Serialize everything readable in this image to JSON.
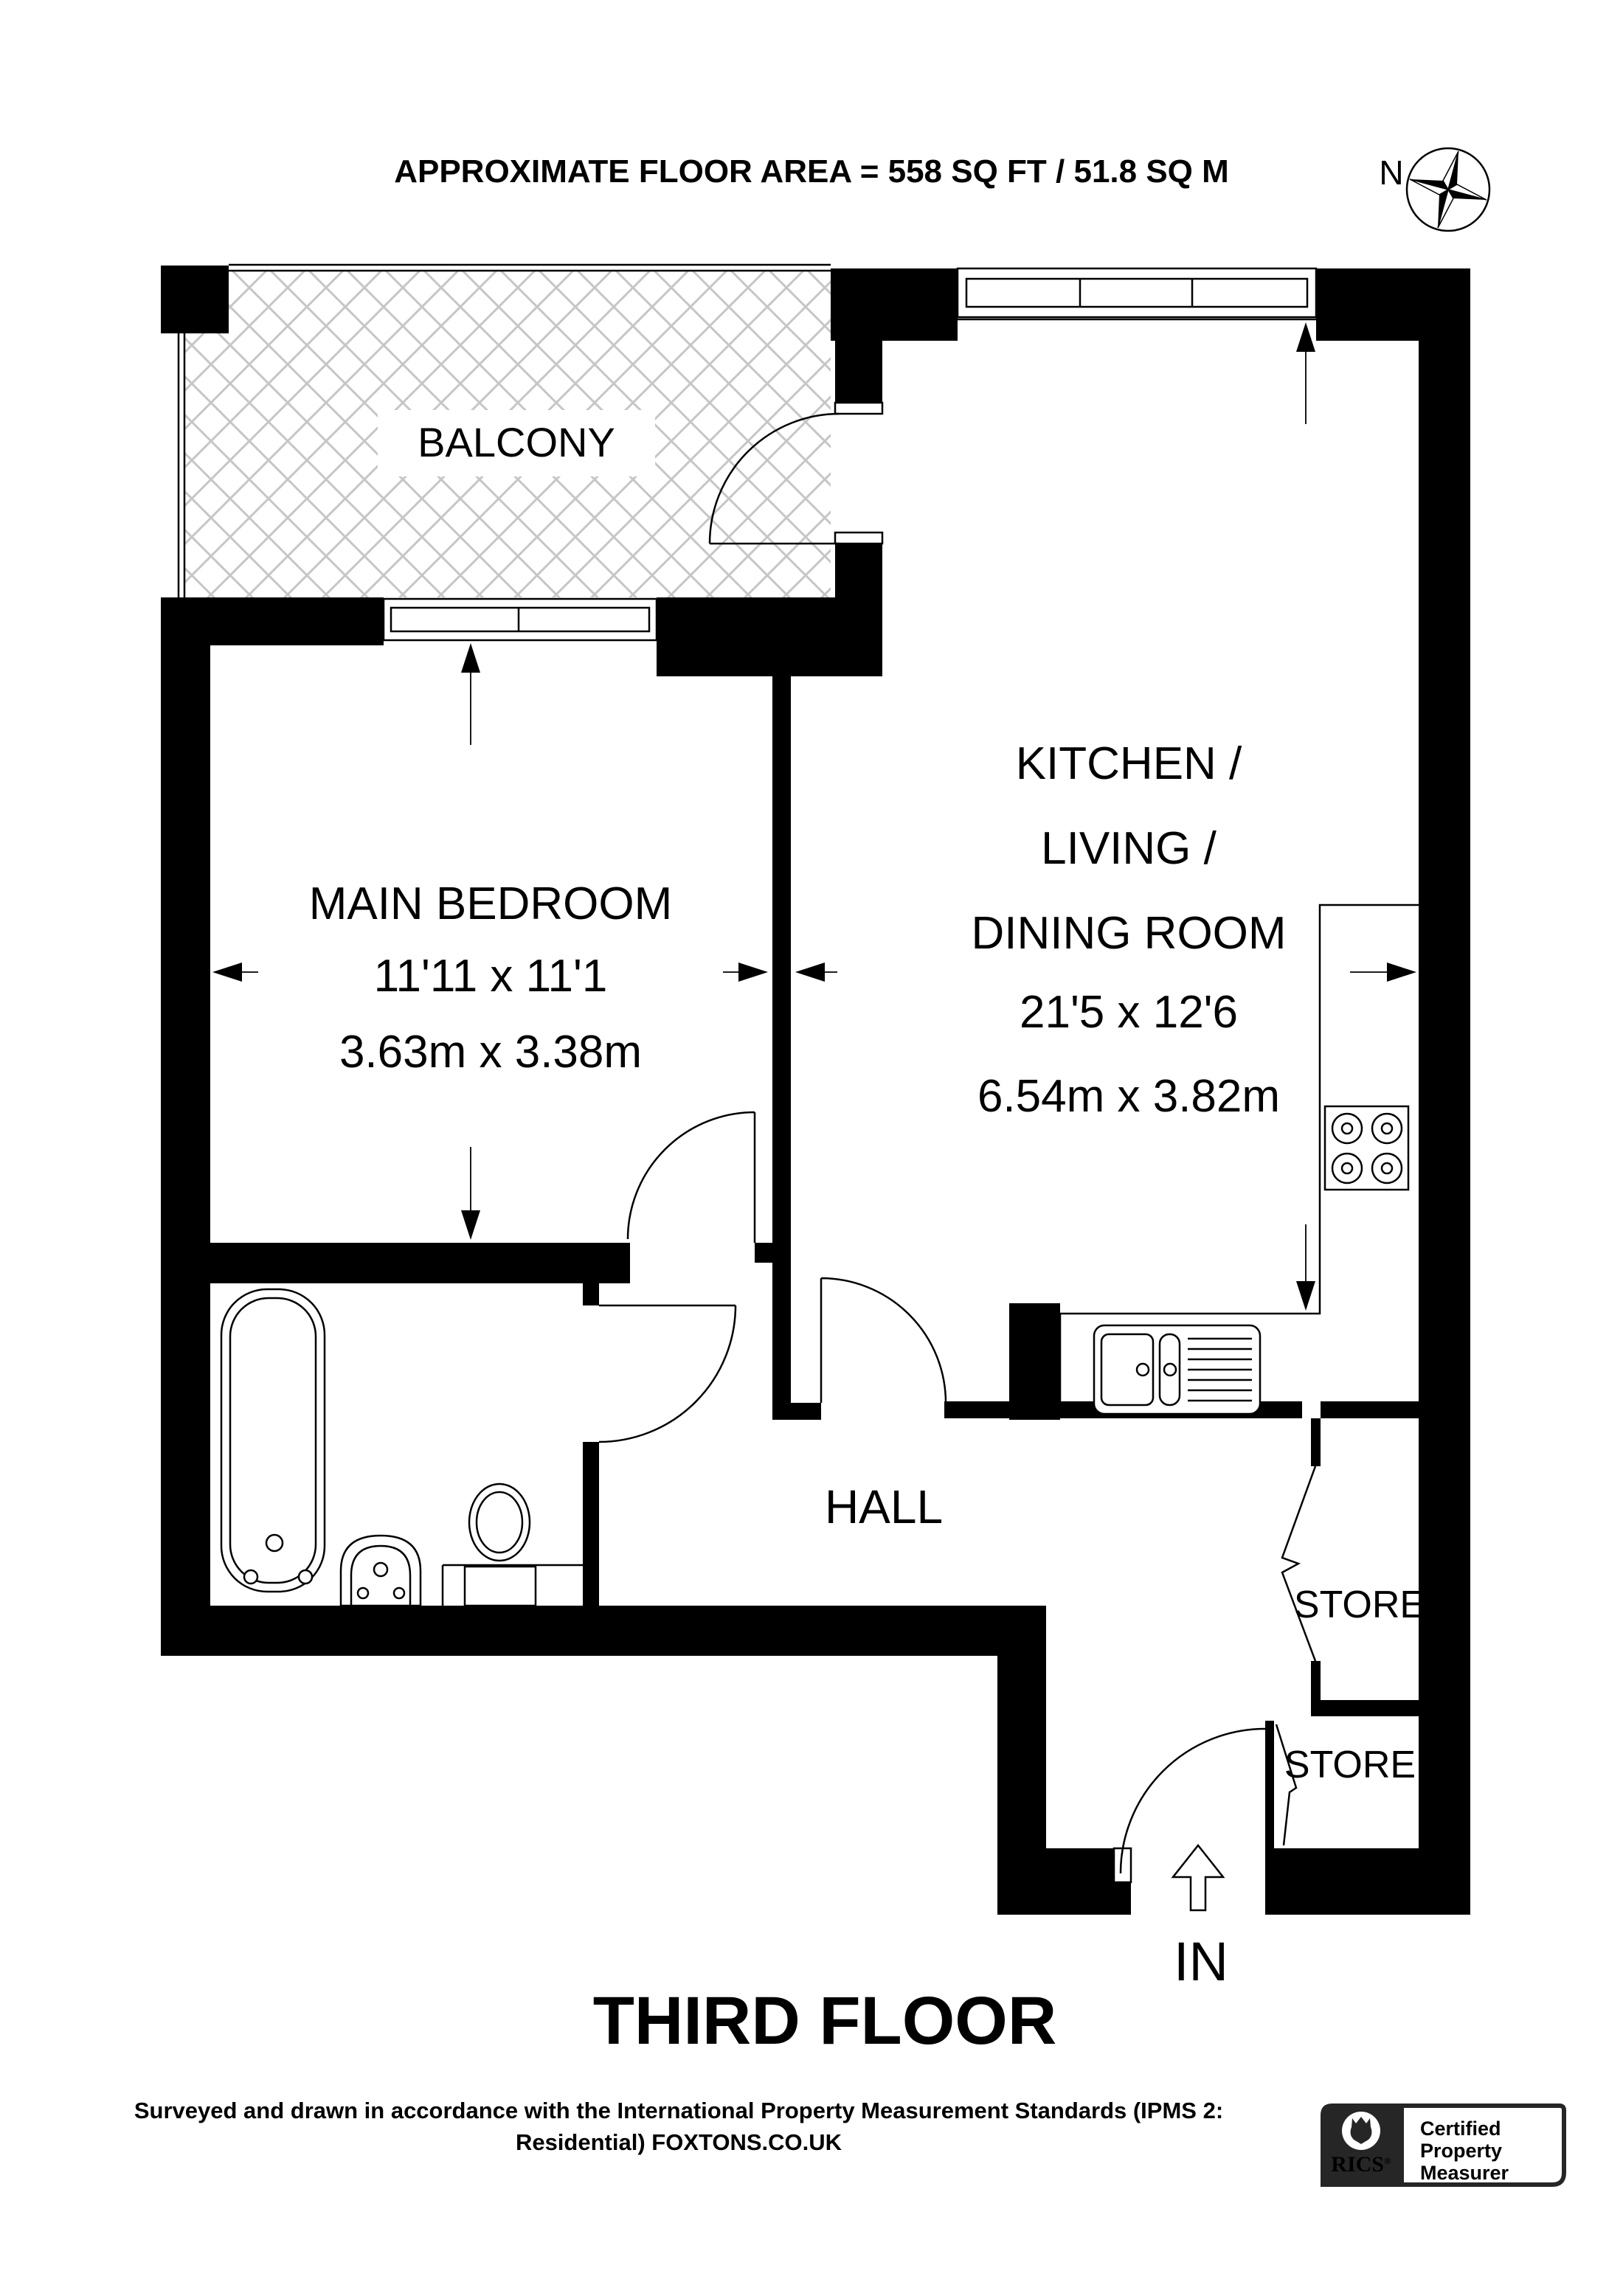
{
  "header": {
    "area_label": "APPROXIMATE FLOOR AREA = 558 SQ FT / 51.8 SQ M"
  },
  "compass": {
    "north_label": "N"
  },
  "rooms": {
    "balcony": {
      "name": "BALCONY"
    },
    "main_bedroom": {
      "name": "MAIN BEDROOM",
      "dims_imperial": "11'11 x 11'1",
      "dims_metric": "3.63m x 3.38m"
    },
    "kitchen": {
      "name_line1": "KITCHEN /",
      "name_line2": "LIVING /",
      "name_line3": "DINING ROOM",
      "dims_imperial": "21'5 x 12'6",
      "dims_metric": "6.54m x 3.82m"
    },
    "hall": {
      "name": "HALL"
    },
    "store_1": {
      "name": "STORE"
    },
    "store_2": {
      "name": "STORE"
    }
  },
  "entrance": {
    "label": "IN"
  },
  "floor": {
    "title": "THIRD FLOOR"
  },
  "footer": {
    "line1": "Surveyed and drawn in accordance with the International Property Measurement Standards (IPMS 2:",
    "line2": "Residential) FOXTONS.CO.UK"
  },
  "badge": {
    "org": "RICS",
    "registered_mark": "®",
    "line1": "Certified",
    "line2": "Property",
    "line3": "Measurer"
  },
  "colors": {
    "wall": "#000000",
    "hatch": "#c6c6c6",
    "badge_dark": "#262626",
    "text": "#000000"
  }
}
